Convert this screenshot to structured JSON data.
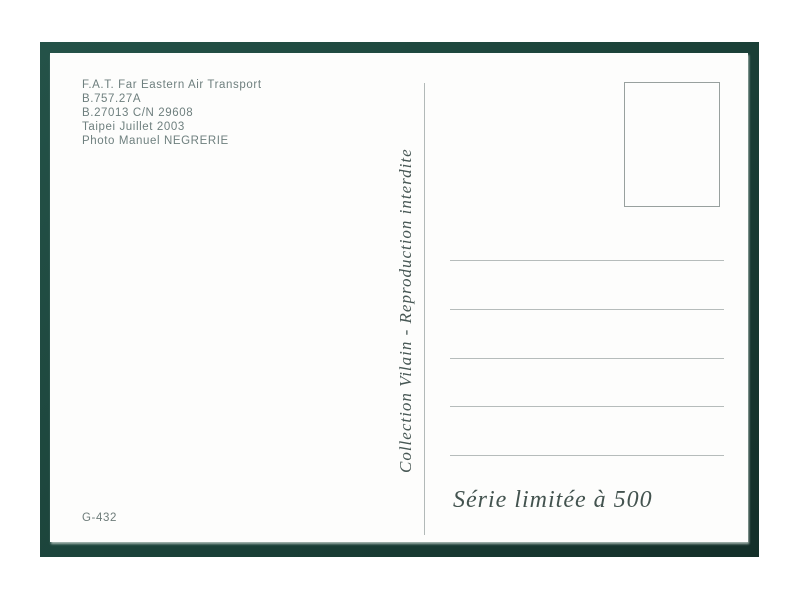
{
  "postcard": {
    "photo_credit": {
      "lines": [
        "F.A.T. Far Eastern Air Transport",
        "B.757.27A",
        "B.27013  C/N 29608",
        "Taipei Juillet 2003",
        "Photo Manuel NEGRERIE"
      ]
    },
    "collection_text": "Collection Vilain - Reproduction interdite",
    "limited_edition_text": "Série limitée à 500",
    "catalog_number": "G-432",
    "address_line_count": 5
  },
  "colors": {
    "frame_green": "#1c443b",
    "credit_text_teal": "#6e7f7e",
    "script_text_dark": "#475754",
    "ruled_line_gray": "#b6bcbb",
    "stamp_box_border": "#98a09e",
    "card_white": "#fdfdfc"
  }
}
